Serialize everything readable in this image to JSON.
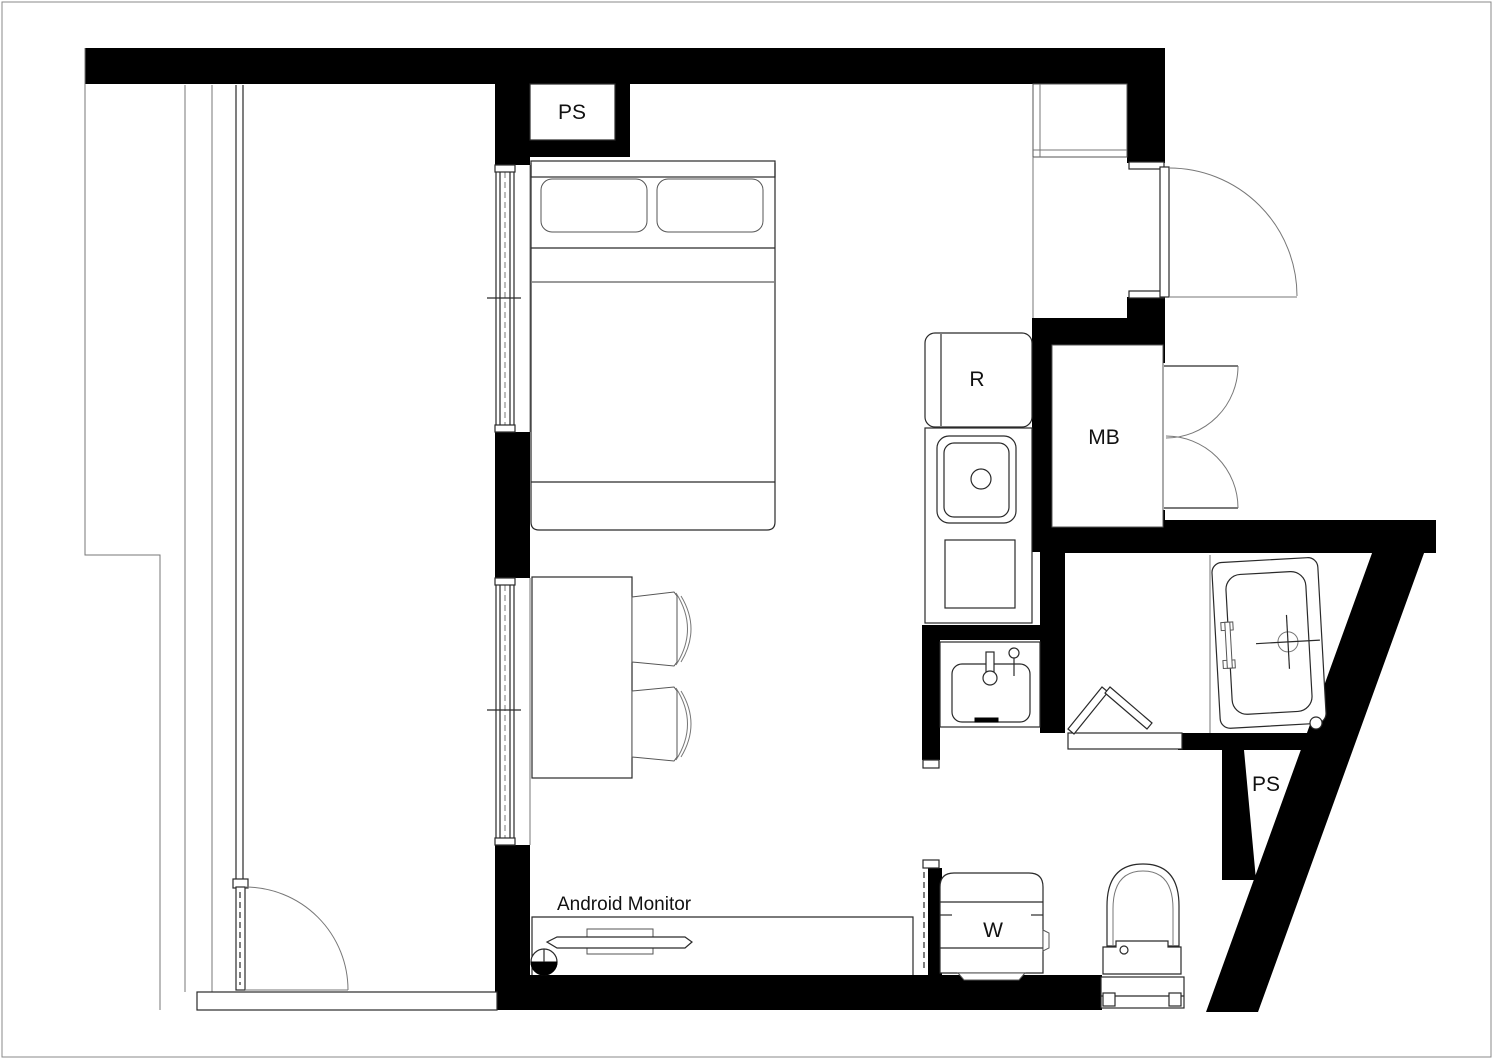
{
  "drawing": {
    "type": "apartment-floor-plan",
    "bg_color": "#ffffff",
    "wall_color": "#000000",
    "line_color": "#2a2a2a",
    "annotations": {
      "ps_top": {
        "text": "PS"
      },
      "refrigerator": {
        "text": "R"
      },
      "meter_box": {
        "text": "MB"
      },
      "monitor_note": {
        "text": "Android Monitor"
      },
      "washer": {
        "text": "W"
      },
      "ps_bottom": {
        "text": "PS"
      }
    },
    "fixtures": [
      "balcony",
      "balcony-door",
      "sliding-window-upper",
      "sliding-window-lower",
      "double-bed",
      "pillows",
      "dining-table",
      "chairs",
      "desk-with-monitor",
      "refrigerator",
      "kitchen-sink",
      "entrance-door",
      "shoe-cabinet",
      "meter-box-double-door",
      "washbasin",
      "bathroom-bifold-door",
      "bathtub",
      "washing-machine",
      "toilet",
      "pipe-shaft-top",
      "pipe-shaft-bottom"
    ]
  }
}
